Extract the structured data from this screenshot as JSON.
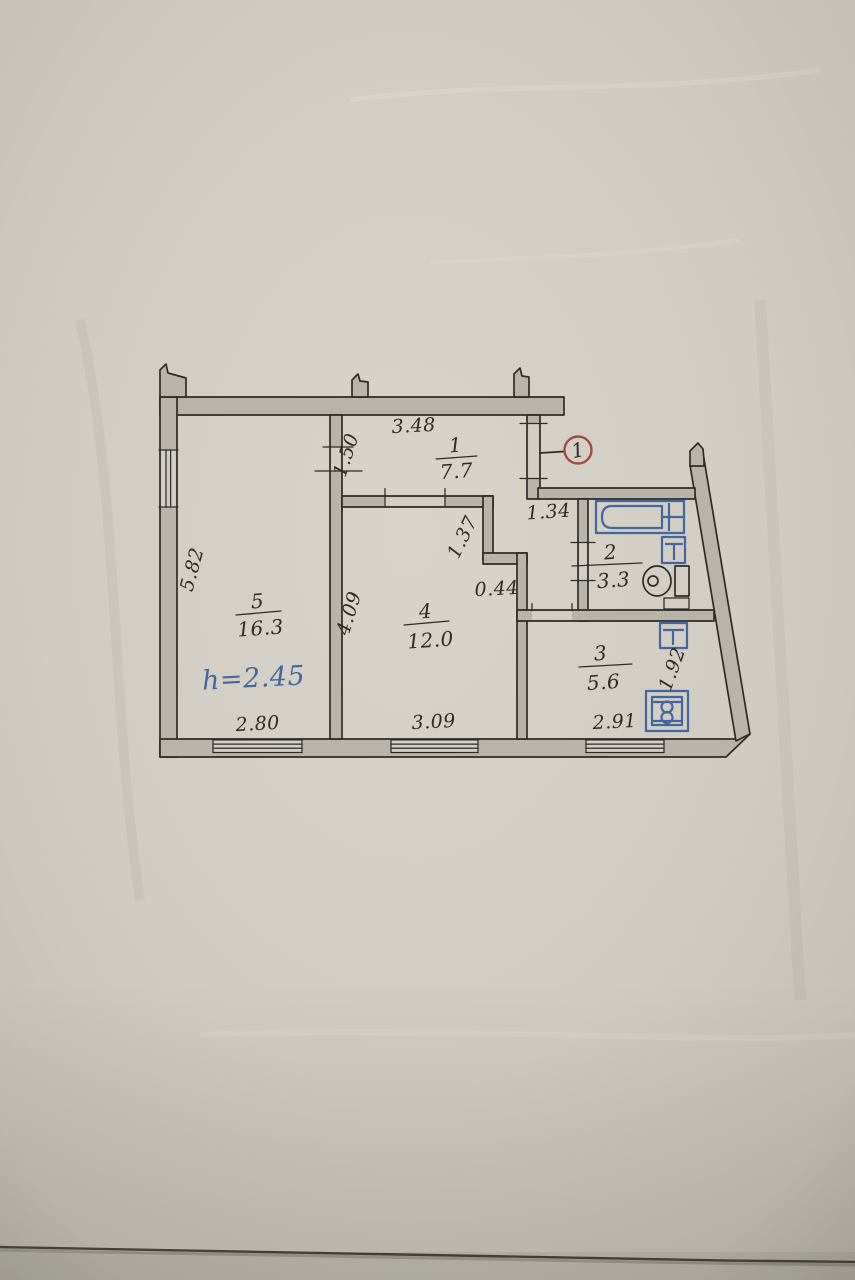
{
  "document": {
    "kind": "hand-drawn apartment floor plan on photographed paper"
  },
  "colors": {
    "paper": "#d2cec5",
    "ink": "#2e2b26",
    "wall_fill": "#b9b4ab",
    "blue": "#44669c",
    "red": "#a2493f"
  },
  "entrance_marker": {
    "number": "1"
  },
  "ceiling_height_note": "h=2.45",
  "rooms": [
    {
      "number": "1",
      "area": "7.7"
    },
    {
      "number": "2",
      "area": "3.3"
    },
    {
      "number": "3",
      "area": "5.6"
    },
    {
      "number": "4",
      "area": "12.0"
    },
    {
      "number": "5",
      "area": "16.3"
    }
  ],
  "dimensions": {
    "hall_top": "3.48",
    "hall_left": "1.50",
    "vestibule_width": "1.34",
    "wall_step_vertical": "1.37",
    "wall_step_horizontal": "0.44",
    "room5_side": "5.82",
    "room4_side": "4.09",
    "room5_bottom": "2.80",
    "room4_bottom": "3.09",
    "room3_bottom": "2.91",
    "room3_side": "1.92"
  }
}
